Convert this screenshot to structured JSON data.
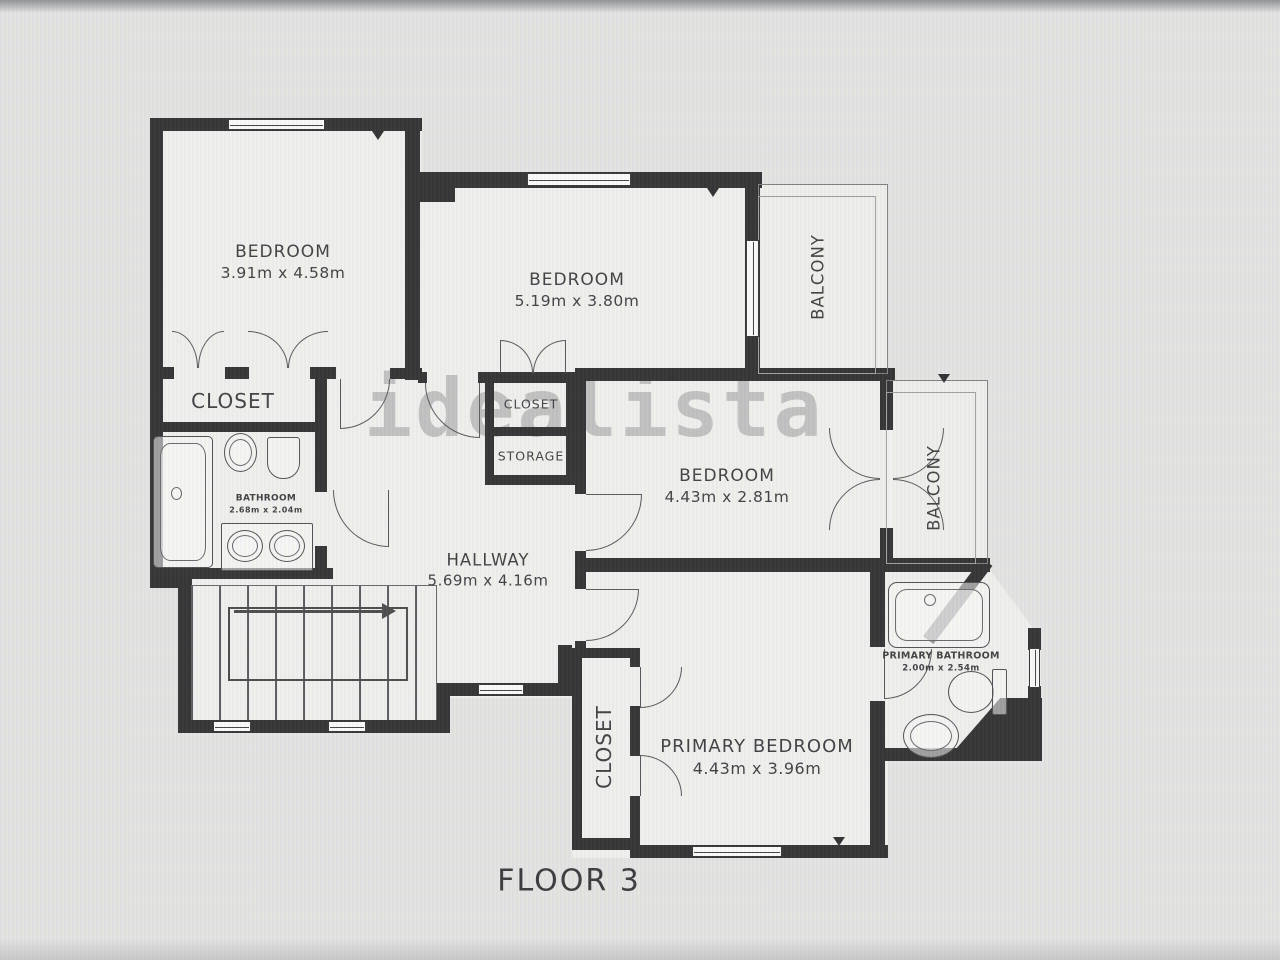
{
  "watermark": {
    "text": "idealista"
  },
  "floor_label": "FLOOR 3",
  "rooms": {
    "bedroom1": {
      "name": "BEDROOM",
      "dims": "3.91m x 4.58m"
    },
    "bedroom2": {
      "name": "BEDROOM",
      "dims": "5.19m x 3.80m"
    },
    "bedroom3": {
      "name": "BEDROOM",
      "dims": "4.43m x 2.81m"
    },
    "primary_bedroom": {
      "name": "PRIMARY BEDROOM",
      "dims": "4.43m x 3.96m"
    },
    "hallway": {
      "name": "HALLWAY",
      "dims": "5.69m x 4.16m"
    },
    "bathroom": {
      "name": "BATHROOM",
      "dims": "2.68m x 2.04m"
    },
    "primary_bathroom": {
      "name": "PRIMARY BATHROOM",
      "dims": "2.00m x 2.54m"
    },
    "closet_main": {
      "name": "CLOSET"
    },
    "closet_small": {
      "name": "CLOSET"
    },
    "storage": {
      "name": "STORAGE"
    },
    "closet_primary": {
      "name": "CLOSET"
    },
    "balcony_top": {
      "name": "BALCONY"
    },
    "balcony_mid": {
      "name": "BALCONY"
    }
  }
}
